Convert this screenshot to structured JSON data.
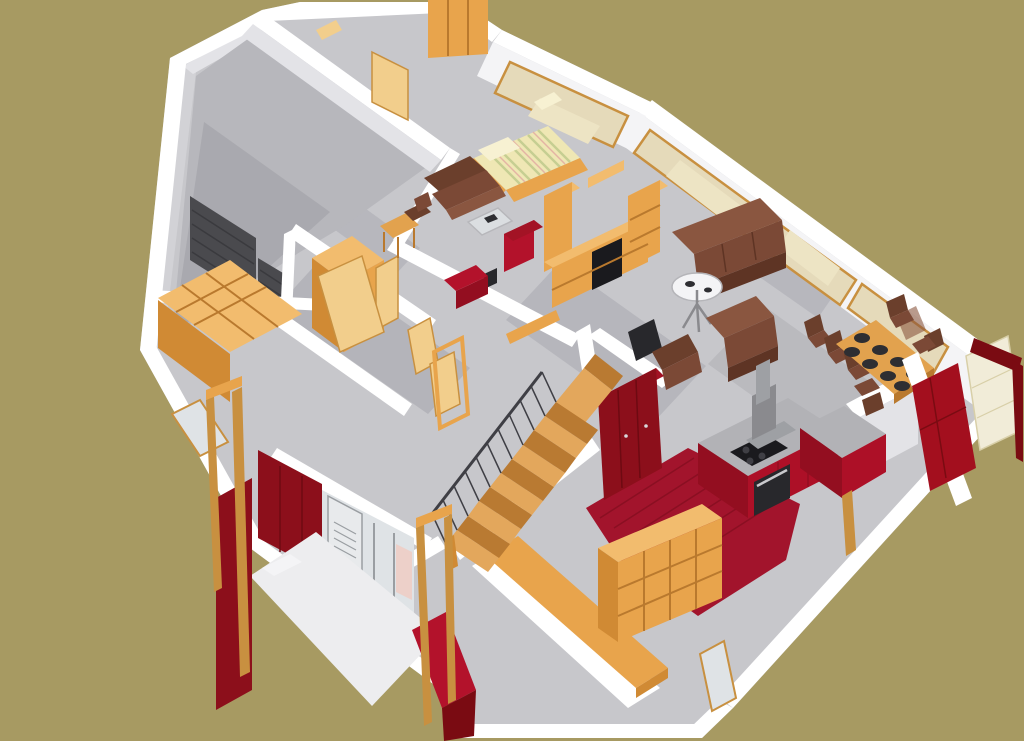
{
  "scene": {
    "type": "architectural-3d-model",
    "view": "birds-eye isometric cutaway (roofless) of a single-story house",
    "style": "SketchUp-like solid shading; no text, menus or UI chrome visible",
    "rooms": [
      {
        "name": "garage",
        "features": [
          "dark gray slatted garage door"
        ]
      },
      {
        "name": "hallway",
        "features": [
          "cube storage shelf",
          "open wooden doors",
          "small wardrobe"
        ]
      },
      {
        "name": "bedroom",
        "features": [
          "double bed with striped cover",
          "brown armchair",
          "glass coffee table",
          "red drawer cabinet",
          "small wooden table and chair",
          "window with view of bed"
        ]
      },
      {
        "name": "living-room",
        "features": [
          "brown three-seat sofa",
          "brown armchair",
          "round pedestal side table",
          "wooden TV wall unit with black TV",
          "dark speaker box",
          "floor-to-ceiling tinted windows"
        ]
      },
      {
        "name": "dining-area",
        "features": [
          "wooden dining table with eight dark plates",
          "six brown chairs"
        ]
      },
      {
        "name": "kitchen",
        "features": [
          "red base cabinets with concrete worktop",
          "black cooktop and oven",
          "stainless range hood",
          "dark red wardrobe",
          "red plank floor"
        ]
      },
      {
        "name": "stair-hall",
        "features": [
          "wooden staircase",
          "black metal railing"
        ]
      },
      {
        "name": "storage-room",
        "features": [
          "large wooden shelving unit",
          "long wooden sideboard",
          "small window"
        ]
      },
      {
        "name": "entrance-porch",
        "features": [
          "dark red facade walls",
          "glass entrance door with louvered shutter",
          "red pillars",
          "wooden pergola frames",
          "white porch slab"
        ]
      },
      {
        "name": "terrace-corner",
        "features": [
          "red accent wall",
          "cream lounger",
          "dark red edging"
        ]
      }
    ]
  },
  "palette": {
    "khaki": "#A79A62",
    "white": "#FFFFFF",
    "wallLight": "#F4F4F6",
    "wallFace": "#E3E3E7",
    "wallShade": "#D2D2D6",
    "floor": "#C7C7CB",
    "shadow": "#9C9CA2",
    "garageFloor": "#B7B7BC",
    "garageDoor": "#4A4A4E",
    "garageDoorLine": "#3A3A3E",
    "wood": "#E8A44C",
    "woodLight": "#F2BC6E",
    "woodDark": "#D08A34",
    "woodDeep": "#B9792E",
    "woodPale": "#F2CE8C",
    "frameWood": "#C89040",
    "tableWood": "#E2A24E",
    "mattress": "#EFE7B4",
    "mattressStripe": "#C6CE92",
    "stripePink": "#E4B4A4",
    "pillow": "#F7F1D2",
    "brownDark": "#6B3F2C",
    "brown": "#7B4936",
    "brownLight": "#8A5640",
    "brownDeep": "#5E3424",
    "red": "#B3122B",
    "kitchenRed": "#AD1027",
    "kitchenRedSide": "#930E20",
    "wineRed": "#8C0F1B",
    "wineRedDark": "#6E0A12",
    "darkRed": "#7A0B12",
    "redTop": "#A31325",
    "accentRed": "#A30F1E",
    "floorRed": "#A2142C",
    "floorRedLine": "#8A0F22",
    "counter": "#B2B2B6",
    "black": "#1A1A1E",
    "nearBlack": "#28282C",
    "plate": "#2E2E32",
    "steel": "#3F3F45",
    "metal": "#8A8A8E",
    "metalLight": "#9EA0A4",
    "ovenSteel": "#C9C9CD",
    "glassTan": "#E5DABA",
    "glassTanLight": "#EDE4C4",
    "glassCool": "#DFE3E6",
    "doorWhite": "#E8EAEC",
    "doorLine": "#9A9EA2",
    "salmon": "#F2C8BC",
    "lounger": "#F1ECD8",
    "loungerLine": "#D8CFA8",
    "stairWood": "#C98A3E",
    "stairLight": "#E3A75C",
    "stairDark": "#B97A32",
    "porch": "#EDEDEF",
    "glassStroke": "#B5B5B9",
    "handle": "#D8D8DC"
  }
}
